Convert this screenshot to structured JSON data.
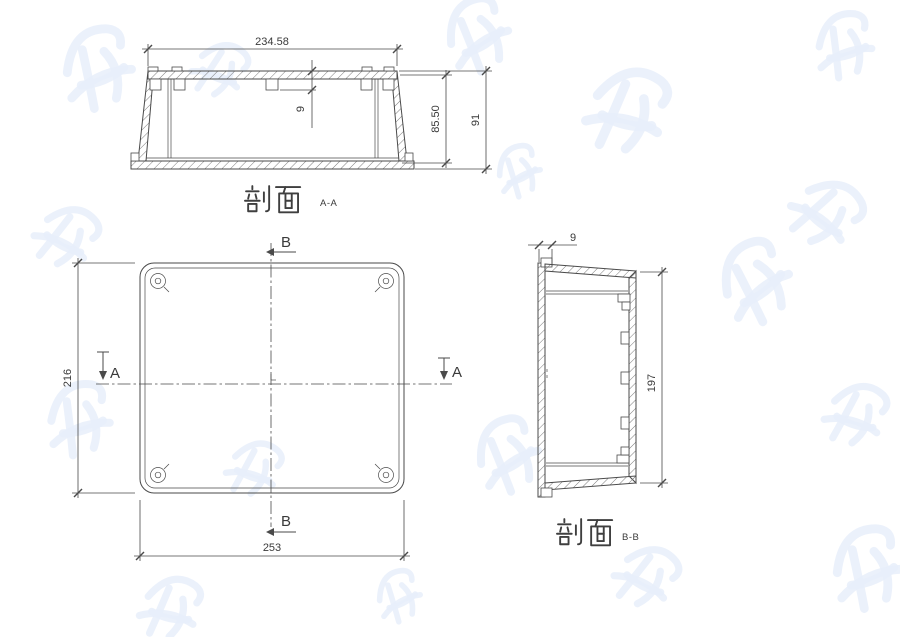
{
  "drawing": {
    "labels": {
      "section_aa_cn": "剖面",
      "section_aa_suffix": "A-A",
      "section_bb_cn": "剖面",
      "section_bb_suffix": "B-B"
    },
    "dimensions": {
      "aa_width": "234.58",
      "aa_boss_depth": "9",
      "aa_inner_height": "85.50",
      "aa_outer_height": "91",
      "plan_height": "216",
      "plan_width": "253",
      "bb_lid_thickness": "9",
      "bb_inner_length": "197"
    },
    "section_markers": {
      "a": "A",
      "b": "B"
    },
    "colors": {
      "background": "#ffffff",
      "line": "#4a4a4a",
      "dim_text": "#3a3a3a",
      "hatch": "#7d7d7d",
      "watermark": "#e7effa"
    }
  }
}
